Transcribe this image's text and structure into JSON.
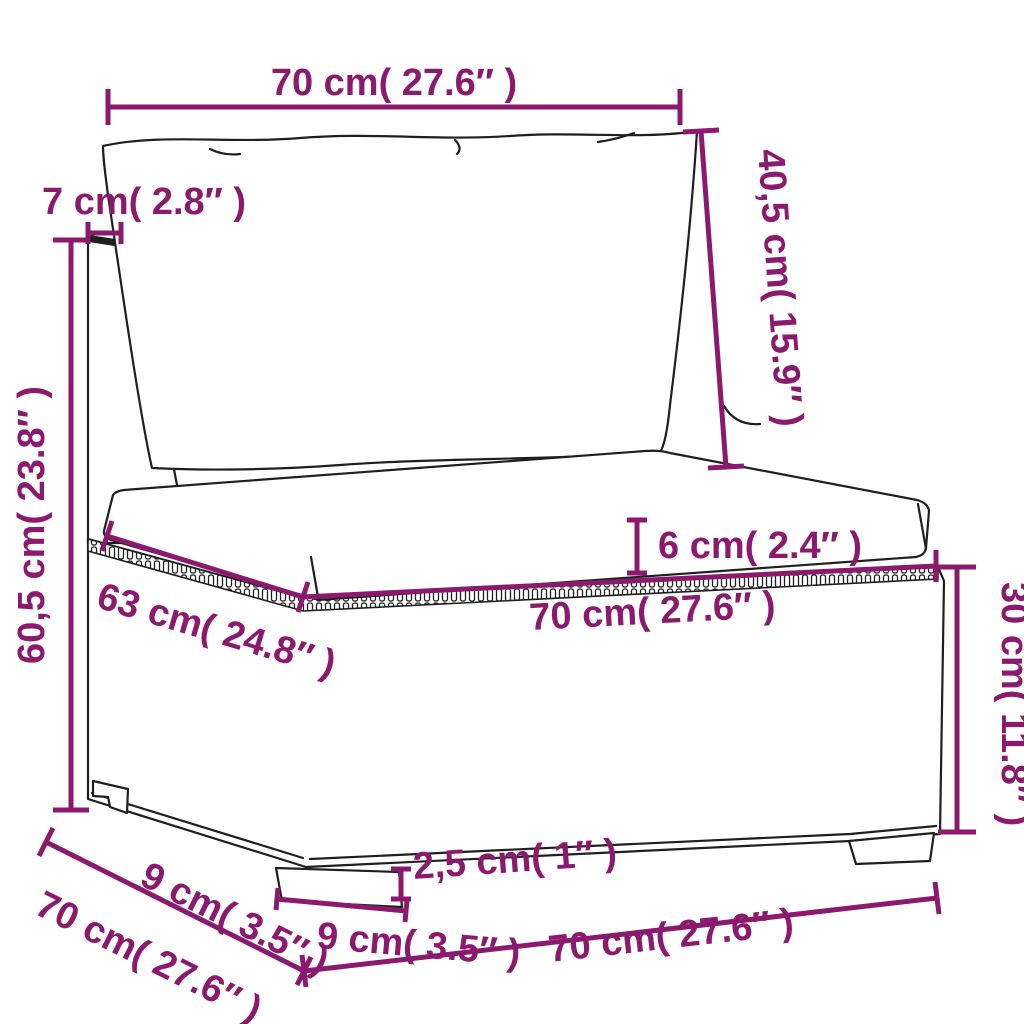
{
  "figure": {
    "title": "Rattan sofa section dimension diagram",
    "product": "poly rattan garden sofa middle section with back and seat cushions",
    "accent_color": "#8b1a6e",
    "line_color": "#1f1f1f",
    "background_color": "#ffffff"
  },
  "dims": {
    "back_cushion_width": {
      "label": "70 cm( 27.6″ )"
    },
    "back_post_depth": {
      "label": "7 cm( 2.8″ )"
    },
    "back_cushion_height": {
      "label": "40,5 cm( 15.9″ )"
    },
    "total_height": {
      "label": "60,5 cm( 23.8″ )"
    },
    "seat_cushion_thickness": {
      "label": "6 cm( 2.4″ )"
    },
    "seat_depth": {
      "label": "63 cm( 24.8″ )"
    },
    "seat_width": {
      "label": "70 cm( 27.6″ )"
    },
    "base_height": {
      "label": "30 cm( 11.8″ )"
    },
    "side_leg_inset": {
      "label": "9 cm( 3.5″ )"
    },
    "total_depth": {
      "label": "70 cm( 27.6″ )"
    },
    "leg_height": {
      "label": "2,5 cm( 1″ )"
    },
    "front_leg_width": {
      "label": "9 cm( 3.5″ )"
    },
    "total_width": {
      "label": "70 cm( 27.6″ )"
    }
  }
}
